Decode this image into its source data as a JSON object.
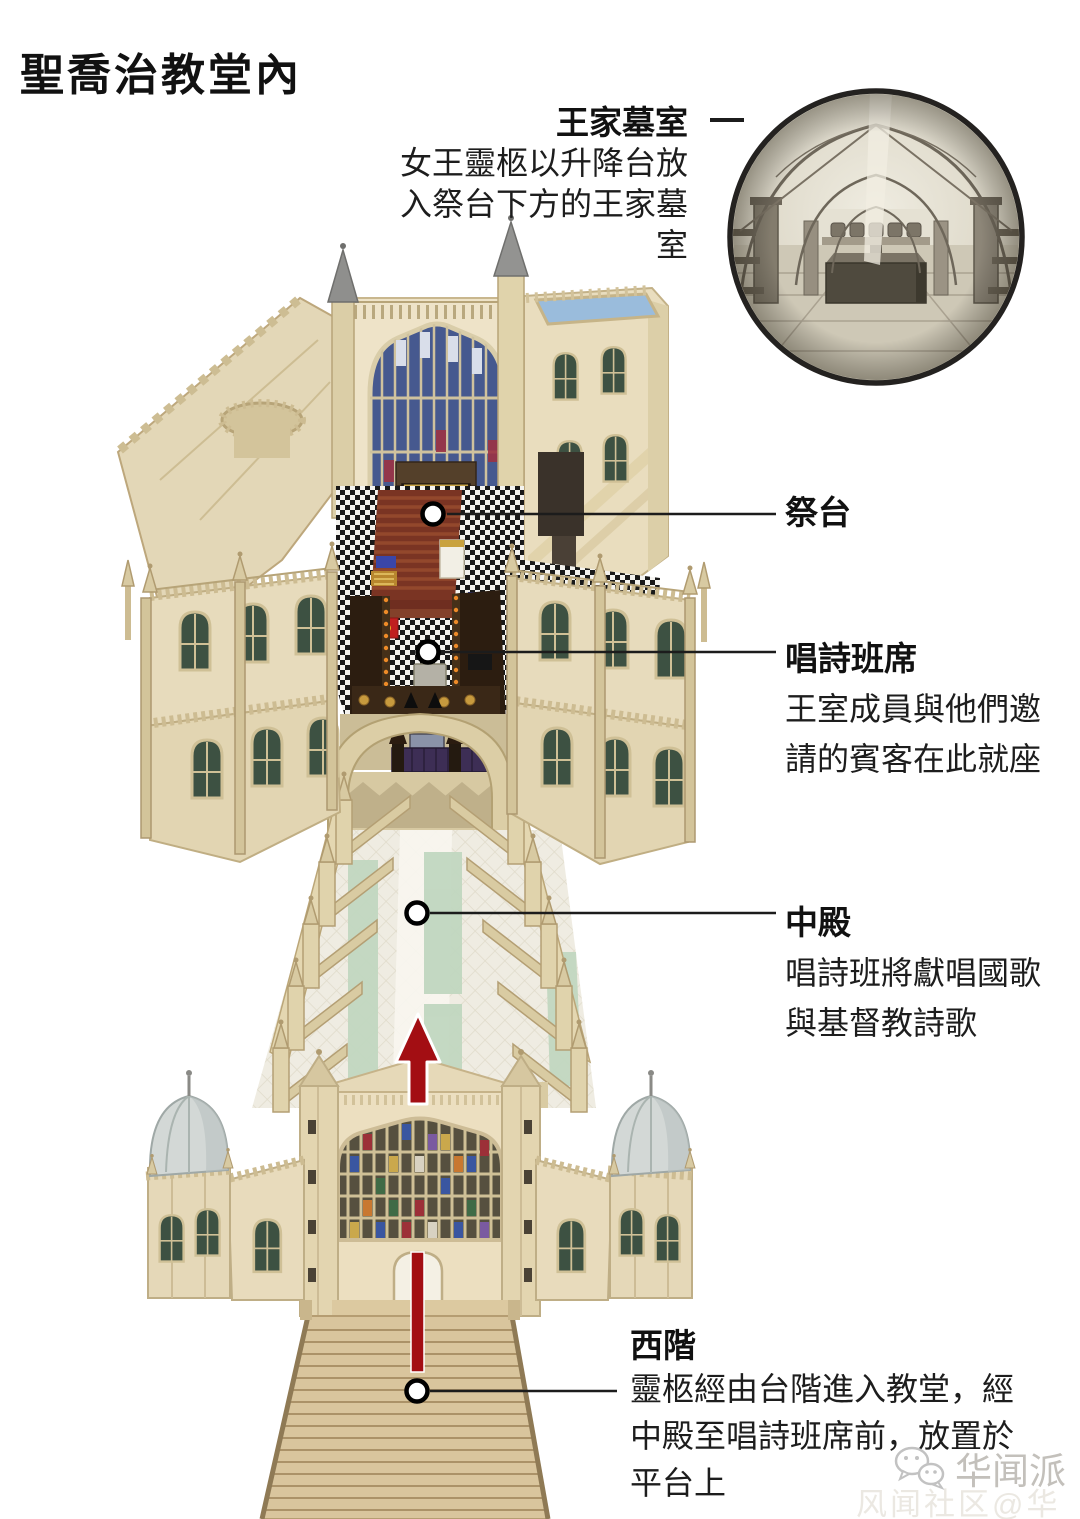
{
  "title": "聖喬治教堂內",
  "callouts": {
    "royal_vault": {
      "label": "王家墓室",
      "desc1": "女王靈柩以升降台放",
      "desc2": "入祭台下方的王家墓",
      "desc3": "室"
    },
    "altar": {
      "label": "祭台"
    },
    "choir": {
      "label": "唱詩班席",
      "desc1": "王室成員與他們邀",
      "desc2": "請的賓客在此就座"
    },
    "nave": {
      "label": "中殿",
      "desc1": "唱詩班將獻唱國歌",
      "desc2": "與基督教詩歌"
    },
    "west_steps": {
      "label": "西階",
      "desc1": "靈柩經由台階進入教堂，經",
      "desc2": "中殿至唱詩班席前，放置於",
      "desc3": "平台上"
    }
  },
  "watermark": {
    "source": "华闻派",
    "ghost": "风闻社区@华闻派",
    "icon": "wechat-icon"
  },
  "inset": {
    "name": "royal-vault-engraving"
  },
  "colors": {
    "accent_red": "#a30e13",
    "stone": "#e8dcbd",
    "glass_blue": "#46598f",
    "carpet_red": "#7a3423",
    "carpet_green": "#c1d7c0",
    "text": "#111111"
  }
}
